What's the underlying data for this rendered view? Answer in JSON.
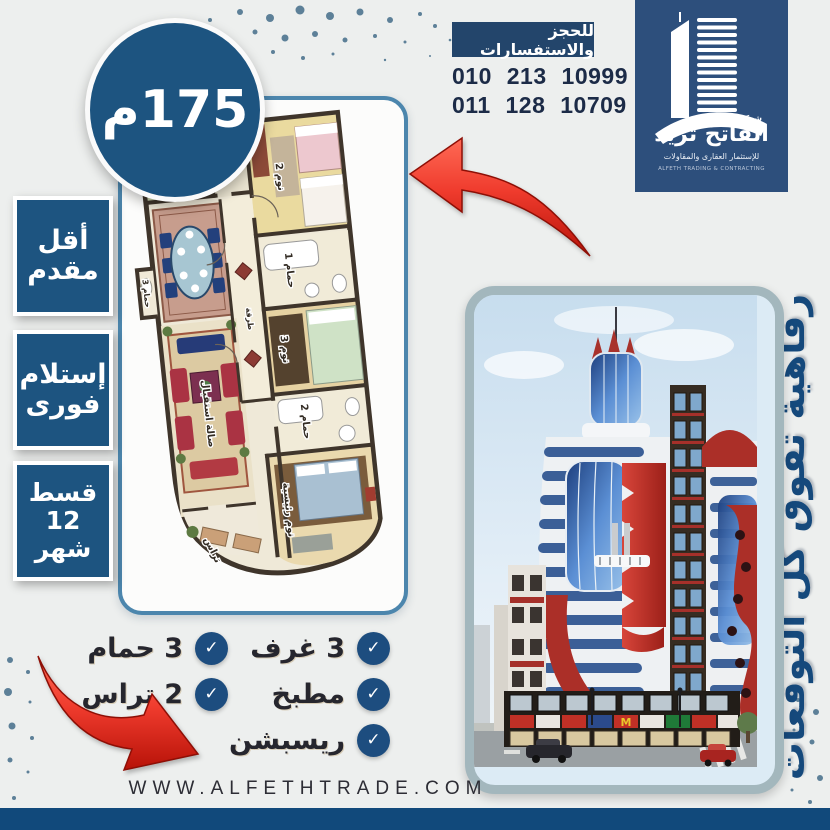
{
  "page": {
    "website": "WWW.ALFETHTRADE.COM"
  },
  "header": {
    "booking_banner": "للحجز والاستفسارات",
    "phones": [
      "010 213 10999",
      "011 128 10709"
    ],
    "logo": {
      "prefix": "شركة",
      "company": "الفاتح تريد",
      "subtitle": "للإستثمار العقارى والمقاولات",
      "subtitle_en": "ALFETH TRADING & CONTRACTING"
    }
  },
  "badges": {
    "area": "175م",
    "items": [
      {
        "name": "lowest-downpayment",
        "lines": [
          "أقل",
          "مقدم"
        ]
      },
      {
        "name": "immediate-delivery",
        "lines": [
          "إستلام",
          "فورى"
        ]
      },
      {
        "name": "installments-12-months",
        "lines": [
          "قسط",
          "12",
          "شهر"
        ]
      }
    ]
  },
  "tagline": "رفاهية تفوق كل التوقعات",
  "features": {
    "right_column": [
      "3 غرف",
      "مطبخ",
      "ريسبشن"
    ],
    "left_column": [
      "3 حمام",
      "2 تراس"
    ]
  },
  "floorplan": {
    "rooms": [
      "مطبخ",
      "نوم 2",
      "حمام 1",
      "نوم 3",
      "حمام 2",
      "نوم رئيسية",
      "صالة استقبال",
      "طرقة",
      "تراس",
      "حمام 3"
    ]
  },
  "icons": {
    "check": "✓"
  },
  "colors": {
    "accent_blue": "#1d5480",
    "navy_banner": "#23456b",
    "logo_panel": "#2d4f7c",
    "check_circle": "#1d4d7f",
    "red_arrow": "#e8392e",
    "bottom_bar": "#11497b",
    "plan_border": "#4c86ad",
    "photo_border": "#a3b7bd"
  }
}
